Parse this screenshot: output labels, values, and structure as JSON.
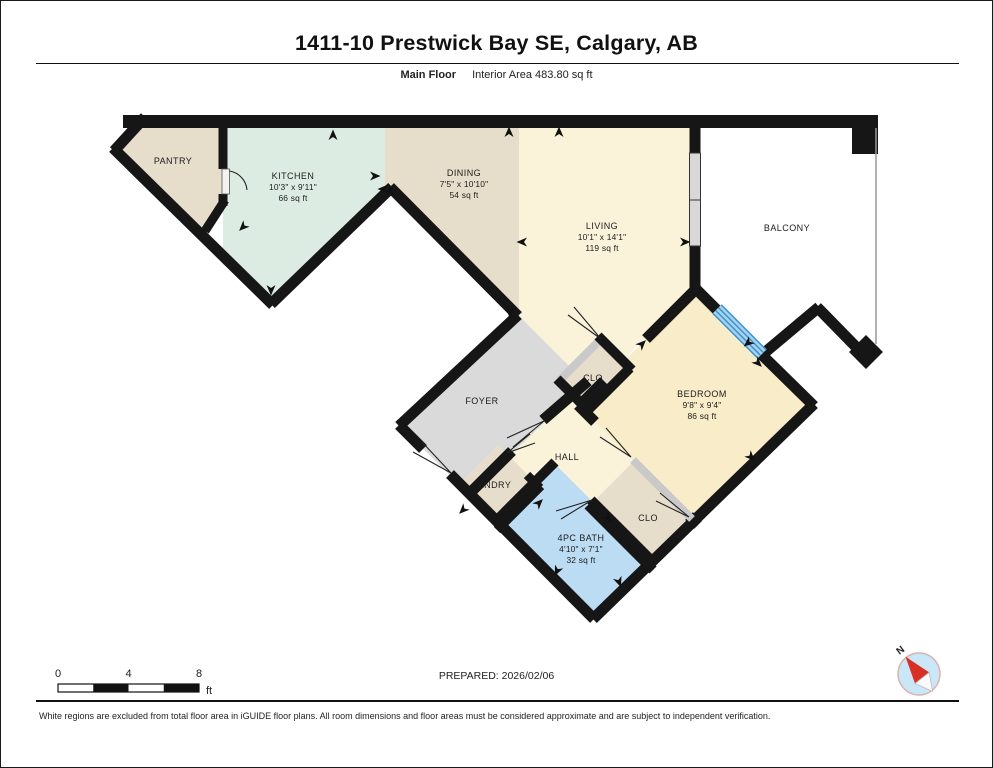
{
  "page": {
    "title": "1411-10 Prestwick Bay SE, Calgary, AB",
    "floor_label": "Main Floor",
    "area_label": "Interior Area 483.80 sq ft",
    "prepared": "PREPARED: 2026/02/06",
    "disclaimer": "White regions are excluded from total floor area in iGUIDE floor plans. All room dimensions and floor areas must be considered approximate and are subject to independent verification."
  },
  "scale_bar": {
    "start": "0",
    "mid": "4",
    "end": "8",
    "unit": "ft"
  },
  "compass": {
    "north_label": "N"
  },
  "rooms": {
    "pantry": {
      "label": "PANTRY"
    },
    "kitchen": {
      "label": "KITCHEN",
      "dims": "10'3\" x 9'11\"",
      "area": "66 sq ft"
    },
    "dining": {
      "label": "DINING",
      "dims": "7'5\" x 10'10\"",
      "area": "54 sq ft"
    },
    "living": {
      "label": "LIVING",
      "dims": "10'1\" x 14'1\"",
      "area": "119 sq ft"
    },
    "balcony": {
      "label": "BALCONY"
    },
    "foyer": {
      "label": "FOYER"
    },
    "closet_hall": {
      "label": "CLO"
    },
    "hall": {
      "label": "HALL"
    },
    "laundry": {
      "label": "LNDRY"
    },
    "bath": {
      "label": "4PC BATH",
      "dims": "4'10\" x 7'1\"",
      "area": "32 sq ft"
    },
    "closet_bedroom": {
      "label": "CLO"
    },
    "bedroom": {
      "label": "BEDROOM",
      "dims": "9'8\" x 9'4\"",
      "area": "86 sq ft"
    }
  },
  "colors": {
    "tan": "#e7ddcb",
    "green": "#ddece3",
    "yellow": "#faf3da",
    "yellow2": "#f8ecc9",
    "blue": "#bcdcf3",
    "gray": "#dadada",
    "wall": "#161616",
    "window": "#d8d8d8",
    "slider_light": "#a9d3ee",
    "slider_dark": "#3f96cf",
    "compass": "#c9e7f6",
    "needle": "#d93025"
  }
}
